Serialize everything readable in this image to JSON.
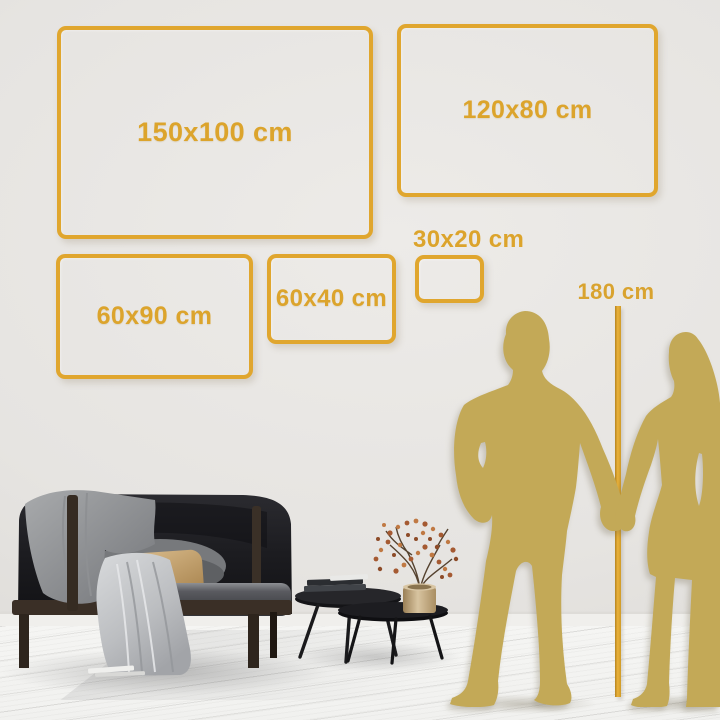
{
  "frames": [
    {
      "label": "150x100 cm",
      "width_cm": 150,
      "height_cm": 100
    },
    {
      "label": "120x80 cm",
      "width_cm": 120,
      "height_cm": 80
    },
    {
      "label": "60x90 cm",
      "width_cm": 60,
      "height_cm": 90
    },
    {
      "label": "60x40 cm",
      "width_cm": 60,
      "height_cm": 40
    },
    {
      "label": "30x20 cm",
      "width_cm": 30,
      "height_cm": 20
    }
  ],
  "height_marker": {
    "label": "180 cm"
  },
  "colors": {
    "frame_gold": "#e0a62e",
    "label_gold": "#dca42c",
    "silhouette_gold": "#c3a957",
    "measure_line_gold": "#eab23a",
    "wall": "#e7e5e2",
    "floor": "#f3f3f1",
    "sofa_dark": "#202024",
    "accent_pillow_tan": "#c9a878"
  },
  "scene_icons": {
    "left_figure": "man-silhouette",
    "right_figure": "woman-silhouette",
    "furniture": [
      "sofa",
      "gray-blanket",
      "light-blanket",
      "back-pillow",
      "accent-pillow",
      "coffee-table-large",
      "coffee-table-small",
      "book-stack",
      "floor-books",
      "brass-vase",
      "blossom-plant"
    ]
  }
}
